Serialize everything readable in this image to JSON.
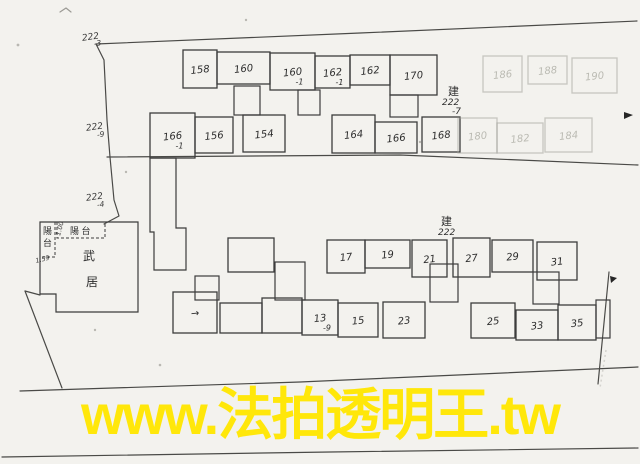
{
  "watermark": {
    "text": "www.法拍透明王.tw",
    "color": "#ffe70a"
  },
  "buildings": {
    "upper": {
      "tag": {
        "char": "建",
        "num": "222",
        "sub": "-7"
      },
      "rooms": [
        {
          "label": "158",
          "x": 183,
          "y": 50,
          "w": 34,
          "h": 38
        },
        {
          "label": "160",
          "x": 217,
          "y": 52,
          "w": 53,
          "h": 32
        },
        {
          "label": "160",
          "sub": "-1",
          "x": 270,
          "y": 53,
          "w": 45,
          "h": 37
        },
        {
          "label": "162",
          "sub": "-1",
          "x": 315,
          "y": 56,
          "w": 35,
          "h": 32
        },
        {
          "label": "162",
          "x": 350,
          "y": 55,
          "w": 40,
          "h": 30
        },
        {
          "label": "170",
          "x": 390,
          "y": 55,
          "w": 47,
          "h": 40
        },
        {
          "label": "186",
          "x": 483,
          "y": 56,
          "w": 39,
          "h": 36,
          "faded": true
        },
        {
          "label": "188",
          "x": 528,
          "y": 56,
          "w": 39,
          "h": 28,
          "faded": true
        },
        {
          "label": "190",
          "x": 572,
          "y": 58,
          "w": 45,
          "h": 35,
          "faded": true
        },
        {
          "label": "166",
          "sub": "-1",
          "x": 150,
          "y": 113,
          "w": 45,
          "h": 45
        },
        {
          "label": "156",
          "x": 195,
          "y": 117,
          "w": 38,
          "h": 36
        },
        {
          "label": "154",
          "x": 243,
          "y": 115,
          "w": 42,
          "h": 37
        },
        {
          "label": "164",
          "x": 332,
          "y": 115,
          "w": 43,
          "h": 38
        },
        {
          "label": "166",
          "x": 375,
          "y": 122,
          "w": 42,
          "h": 31
        },
        {
          "label": "168",
          "x": 422,
          "y": 117,
          "w": 38,
          "h": 35
        },
        {
          "label": "180",
          "x": 458,
          "y": 118,
          "w": 39,
          "h": 35,
          "faded": true
        },
        {
          "label": "182",
          "x": 497,
          "y": 123,
          "w": 46,
          "h": 30,
          "faded": true
        },
        {
          "label": "184",
          "x": 545,
          "y": 118,
          "w": 47,
          "h": 34,
          "faded": true
        }
      ]
    },
    "lower": {
      "tag": {
        "char": "建",
        "num": "222",
        "sub": ""
      },
      "rooms": [
        {
          "label": "",
          "x": 228,
          "y": 238,
          "w": 46,
          "h": 34
        },
        {
          "label": "17",
          "x": 327,
          "y": 240,
          "w": 38,
          "h": 33
        },
        {
          "label": "19",
          "x": 365,
          "y": 240,
          "w": 45,
          "h": 28
        },
        {
          "label": "21",
          "x": 412,
          "y": 240,
          "w": 35,
          "h": 37
        },
        {
          "label": "27",
          "x": 453,
          "y": 238,
          "w": 37,
          "h": 39
        },
        {
          "label": "29",
          "x": 492,
          "y": 240,
          "w": 41,
          "h": 32
        },
        {
          "label": "31",
          "x": 537,
          "y": 242,
          "w": 40,
          "h": 38
        },
        {
          "label": "→",
          "x": 173,
          "y": 292,
          "w": 44,
          "h": 41
        },
        {
          "label": "",
          "x": 220,
          "y": 303,
          "w": 42,
          "h": 30
        },
        {
          "label": "",
          "x": 262,
          "y": 298,
          "w": 40,
          "h": 35
        },
        {
          "label": "13",
          "sub": "-9",
          "x": 302,
          "y": 300,
          "w": 36,
          "h": 35
        },
        {
          "label": "15",
          "x": 338,
          "y": 303,
          "w": 40,
          "h": 34
        },
        {
          "label": "23",
          "x": 383,
          "y": 302,
          "w": 42,
          "h": 36
        },
        {
          "label": "25",
          "x": 471,
          "y": 303,
          "w": 44,
          "h": 35
        },
        {
          "label": "33",
          "x": 516,
          "y": 310,
          "w": 42,
          "h": 30
        },
        {
          "label": "35",
          "x": 558,
          "y": 305,
          "w": 38,
          "h": 35
        }
      ]
    }
  },
  "lots": [
    {
      "num": "222",
      "sub": "-3"
    },
    {
      "num": "222",
      "sub": "-9"
    },
    {
      "num": "222",
      "sub": "-4"
    }
  ],
  "left_unit": {
    "char_top": "武",
    "char_bottom": "居",
    "balcony_left_top": "陽",
    "balcony_left_bottom": "台",
    "balcony_top": "陽 台",
    "dim_left": "1.59",
    "dim_top": "1.00"
  }
}
